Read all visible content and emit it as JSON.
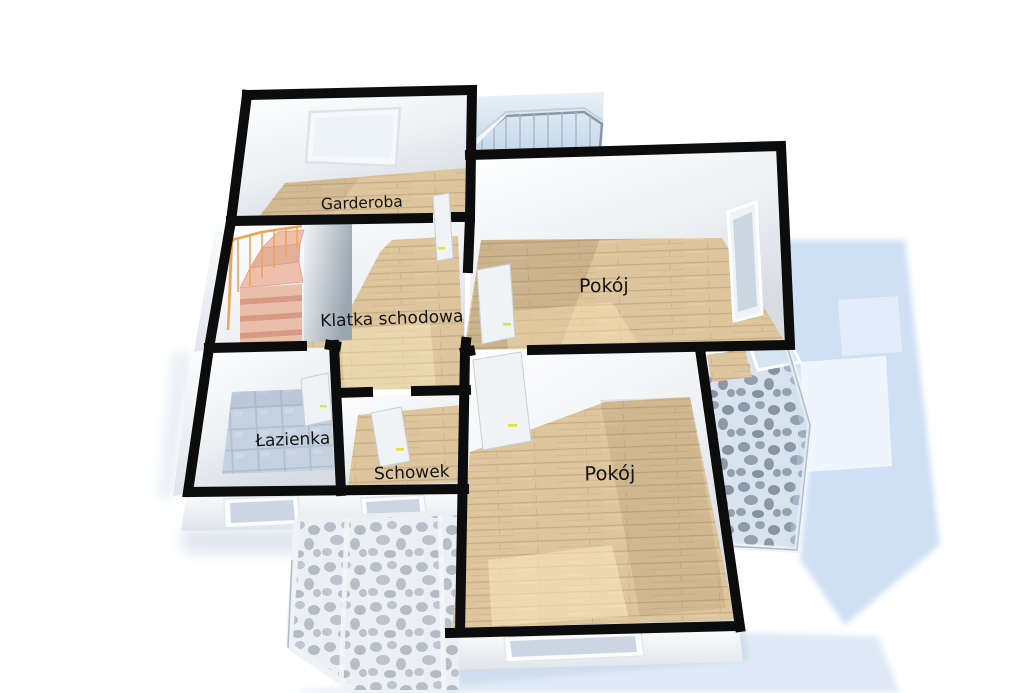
{
  "rooms": [
    {
      "id": "garderoba",
      "label": "Garderoba"
    },
    {
      "id": "klatka-schodowa",
      "label": "Klatka schodowa"
    },
    {
      "id": "pokoj-gorny",
      "label": "Pokój"
    },
    {
      "id": "pokoj-dolny",
      "label": "Pokój"
    },
    {
      "id": "lazienka",
      "label": "Łazienka"
    },
    {
      "id": "schowek",
      "label": "Schowek"
    }
  ],
  "features": {
    "staircase": "spiral-staircase",
    "balconies": [
      "top-glass-balcony",
      "right-bay-window",
      "bottom-bay-window"
    ],
    "door_count": 5,
    "window_count": 5
  },
  "colors": {
    "background": "#ffffff",
    "wall": "#0c0c0c",
    "wood_floor": "#dcc49c",
    "wood_floor_shade": "#c8ab7e",
    "bathroom_tile": "#c6d1df",
    "pebble_tile_light": "#eef1f5",
    "pebble_stone": "#a8b1bc",
    "glass": "#cfe0f0",
    "shadow_blue": "#cfe0f4",
    "stair_step": "#eabfa9",
    "stair_railing": "#f0a452",
    "door_handle": "#e4e43c",
    "label_text": "#141414"
  }
}
